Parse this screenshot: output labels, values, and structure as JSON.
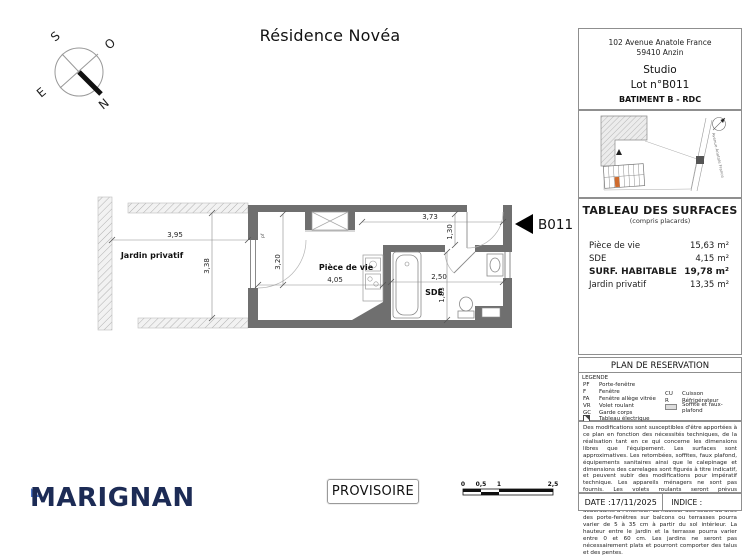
{
  "title": "Résidence Novéa",
  "compass": {
    "s": "S",
    "o": "O",
    "e": "E",
    "n": "N"
  },
  "plan": {
    "unit_marker": "B011",
    "labels": {
      "garden": "Jardin privatif",
      "living": "Pièce de vie",
      "sde": "SDE",
      "pf": "pf"
    },
    "dims": {
      "garden_width": "3,95",
      "garden_height": "3,38",
      "living_height": "3,20",
      "living_width": "4,05",
      "top_width": "3,73",
      "entry_depth": "1,30",
      "sde_width": "2,50",
      "sde_height": "1,83"
    }
  },
  "panel": {
    "address1": "102 Avenue Anatole France",
    "address2": "59410 Anzin",
    "unit_type": "Studio",
    "lot": "Lot n°B011",
    "building": "BATIMENT B - RDC",
    "site": {
      "street": "Avenue Anatole France"
    },
    "surfaces": {
      "title": "TABLEAU DES SURFACES",
      "subtitle": "(compris placards)",
      "rows": [
        {
          "label": "Pièce de vie",
          "value": "15,63",
          "unit": "m²"
        },
        {
          "label": "SDE",
          "value": "4,15",
          "unit": "m²"
        },
        {
          "label": "SURF. HABITABLE",
          "value": "19,78",
          "unit": "m²"
        },
        {
          "label": "Jardin privatif",
          "value": "13,35",
          "unit": "m²"
        }
      ]
    },
    "reservation_title": "PLAN DE RESERVATION",
    "legend": {
      "title": "LEGENDE",
      "left": [
        {
          "abbr": "PF",
          "label": "Porte-fenêtre"
        },
        {
          "abbr": "F",
          "label": "Fenêtre"
        },
        {
          "abbr": "FA",
          "label": "Fenêtre allège vitrée"
        },
        {
          "abbr": "VR",
          "label": "Volet roulant"
        },
        {
          "abbr": "GC",
          "label": "Garde corps"
        },
        {
          "abbr": "",
          "label": "Tableau électrique"
        }
      ],
      "right": [
        {
          "abbr": "CU",
          "label": "Cuisson"
        },
        {
          "abbr": "R",
          "label": "Réfrigérateur"
        },
        {
          "abbr": "",
          "label": "Soffite et faux-plafond"
        }
      ]
    },
    "disclaimer": "Des modifications sont susceptibles d'être apportées à ce plan en fonction des nécessités techniques, de la réalisation tant en ce qui concerne les dimensions libres que l'équipement. Les surfaces sont approximatives. Les retombées, soffites, faux plafond, équipements sanitaires ainsi que le calepinage et dimensions des carrelages sont figurés à titre indicatif, et peuvent subir des modifications pour impératif technique. Les appareils ménagers ne sont pas fournis. Les volets roulants seront prévus conformément à la notice de vente. Les coffres de volet roulant ne sont pas représentés et seront débordants à l'intérieur. La hauteur des seuils au droit des porte-fenêtres sur balcons ou terrasses pourra varier de 5 à 35 cm à partir du sol intérieur. La hauteur entre le jardin et la terrasse pourra varier entre 0 et 60 cm. Les jardins ne seront pas nécessairement plats et pourront comporter des talus et des pentes.",
    "date": "DATE :17/11/2025",
    "indice": "INDICE :"
  },
  "footer": {
    "logo": "MARIGNAN",
    "status": "PROVISOIRE",
    "scale": {
      "t0": "0",
      "t1": "0,5",
      "t2": "1",
      "t3": "2,5"
    }
  },
  "colors": {
    "wall": "#6f6f6f",
    "accent_orange": "#cf6b2e",
    "logo_navy": "#1c2b55",
    "logo_blue": "#4a72c4"
  }
}
